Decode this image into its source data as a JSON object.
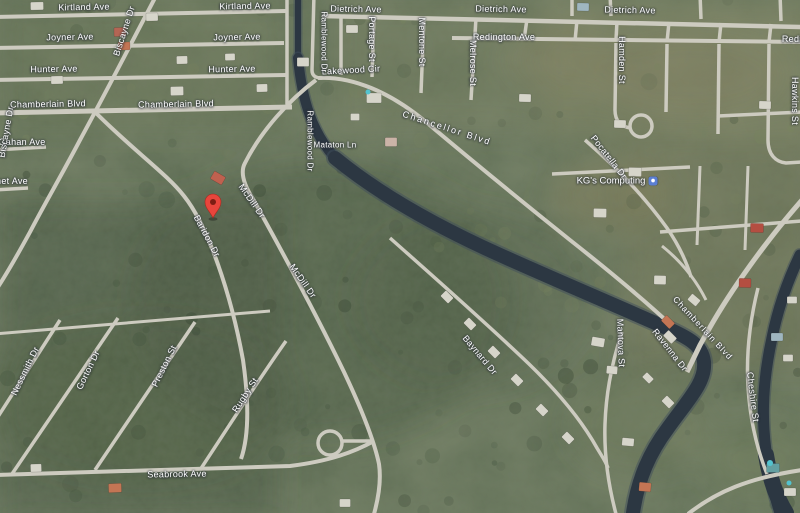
{
  "map": {
    "view_type": "satellite",
    "colors": {
      "water": "#25303c",
      "road": "#cfccc0",
      "label_text": "#ffffff",
      "vegetation_base": "#5d6b51",
      "pin": "#e8453c",
      "pin_hole": "#7d1d13",
      "place_icon": "#5b7fd4"
    },
    "location_pin": {
      "x": 213,
      "y": 218
    },
    "place_label": {
      "text": "KG's Computing",
      "x": 617,
      "y": 181
    },
    "street_labels": [
      {
        "text": "Kirtland Ave",
        "x": 84,
        "y": 7,
        "r": -1
      },
      {
        "text": "Kirtland Ave",
        "x": 245,
        "y": 6,
        "r": -1
      },
      {
        "text": "Joyner Ave",
        "x": 70,
        "y": 37,
        "r": -1
      },
      {
        "text": "Joyner Ave",
        "x": 237,
        "y": 37,
        "r": -1
      },
      {
        "text": "Hunter Ave",
        "x": 54,
        "y": 69,
        "r": -1
      },
      {
        "text": "Hunter Ave",
        "x": 232,
        "y": 69,
        "r": -1
      },
      {
        "text": "Chamberlain Blvd",
        "x": 48,
        "y": 104,
        "r": -1
      },
      {
        "text": "Chamberlain Blvd",
        "x": 176,
        "y": 104,
        "r": -1
      },
      {
        "text": "Gahan Ave",
        "x": 22,
        "y": 142,
        "r": 0
      },
      {
        "text": "net Ave",
        "x": 12,
        "y": 181,
        "r": 0
      },
      {
        "text": "Dietrich Ave",
        "x": 356,
        "y": 9,
        "r": 1
      },
      {
        "text": "Dietrich Ave",
        "x": 501,
        "y": 9,
        "r": 1
      },
      {
        "text": "Dietrich Ave",
        "x": 630,
        "y": 10,
        "r": 1
      },
      {
        "text": "Redington Ave",
        "x": 504,
        "y": 37,
        "r": 0
      },
      {
        "text": "Redington Ave",
        "x": 813,
        "y": 39,
        "r": 0
      },
      {
        "text": "Lakewood Cir",
        "x": 351,
        "y": 70,
        "r": -3
      },
      {
        "text": "Biscayne Dr",
        "x": 124,
        "y": 31,
        "r": -72
      },
      {
        "text": "Biscayne Dr",
        "x": 6,
        "y": 132,
        "r": -80
      },
      {
        "text": "Ramblewood Dr",
        "x": 324,
        "y": 42,
        "r": 90,
        "s": 8
      },
      {
        "text": "Ramblewood Dr",
        "x": 310,
        "y": 141,
        "r": 90,
        "s": 8
      },
      {
        "text": "Portage St",
        "x": 372,
        "y": 39,
        "r": 90
      },
      {
        "text": "Mentone St",
        "x": 422,
        "y": 42,
        "r": 90
      },
      {
        "text": "Melrose St",
        "x": 473,
        "y": 63,
        "r": 90
      },
      {
        "text": "Hamden St",
        "x": 622,
        "y": 60,
        "r": 90
      },
      {
        "text": "Hawkins St",
        "x": 795,
        "y": 101,
        "r": 90
      },
      {
        "text": "Chancellor Blvd",
        "x": 447,
        "y": 128,
        "r": 18,
        "ls": 2
      },
      {
        "text": "Pocatella Dr",
        "x": 609,
        "y": 157,
        "r": 52
      },
      {
        "text": "Mataton Ln",
        "x": 335,
        "y": 145,
        "r": 0,
        "s": 8
      },
      {
        "text": "McDill Dr",
        "x": 252,
        "y": 201,
        "r": 55
      },
      {
        "text": "Baridon Dr",
        "x": 207,
        "y": 236,
        "r": 62
      },
      {
        "text": "McDill Dr",
        "x": 303,
        "y": 281,
        "r": 55
      },
      {
        "text": "Baynard Dr",
        "x": 480,
        "y": 355,
        "r": 50
      },
      {
        "text": "Chamberlain Blvd",
        "x": 703,
        "y": 328,
        "r": 47,
        "s": 8.5,
        "ls": 1
      },
      {
        "text": "Ravenna Dr",
        "x": 670,
        "y": 350,
        "r": 52
      },
      {
        "text": "Mantova St",
        "x": 621,
        "y": 343,
        "r": 88
      },
      {
        "text": "Cheshire St",
        "x": 753,
        "y": 397,
        "r": 83
      },
      {
        "text": "Nessmith Dr",
        "x": 25,
        "y": 371,
        "r": -64
      },
      {
        "text": "Gorton Dr",
        "x": 88,
        "y": 370,
        "r": -64
      },
      {
        "text": "Preston St",
        "x": 164,
        "y": 366,
        "r": -64
      },
      {
        "text": "Rugby St",
        "x": 245,
        "y": 395,
        "r": -57
      },
      {
        "text": "Seabrook Ave",
        "x": 177,
        "y": 474,
        "r": -1
      }
    ]
  }
}
